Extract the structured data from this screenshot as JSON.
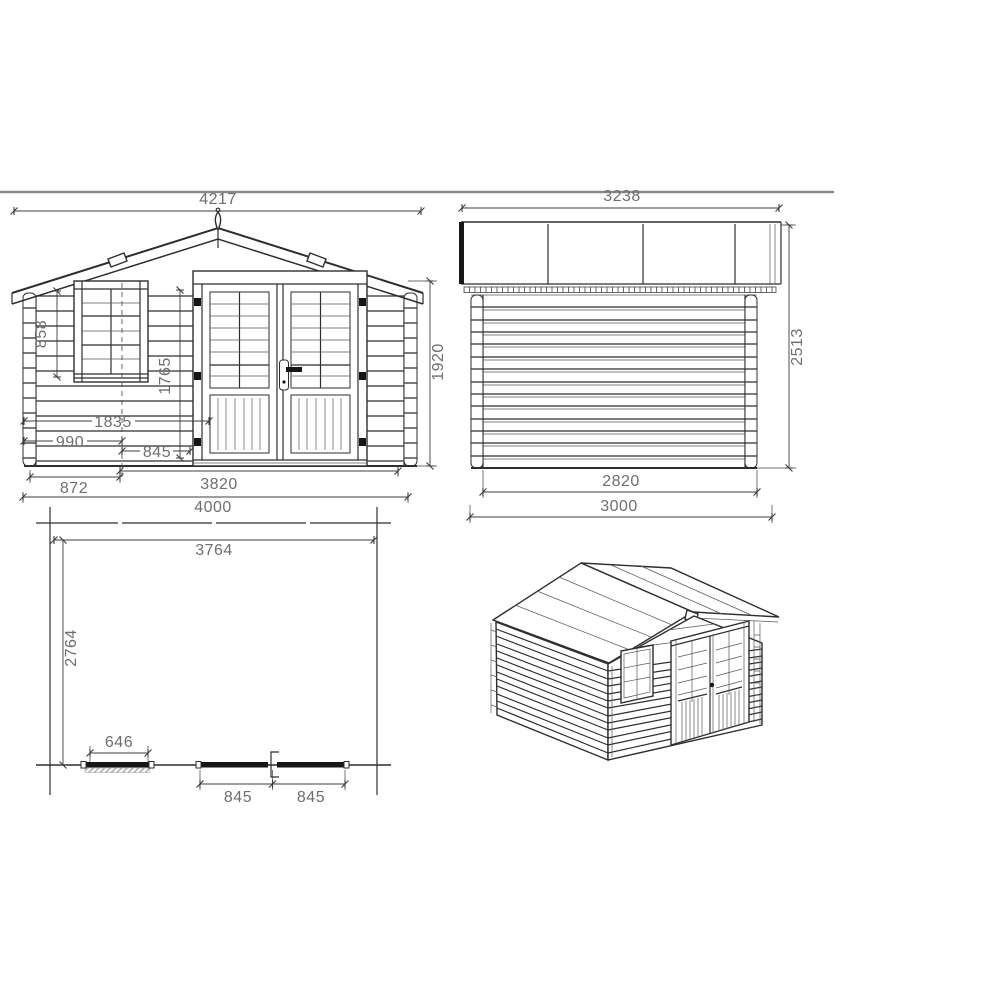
{
  "drawing": {
    "subject": "log-cabin-dimension-drawing",
    "views": {
      "front_elevation": {
        "dimensions": {
          "roof_width": "4217",
          "wall_height": "1920",
          "window_height": "858",
          "door_height": "1765",
          "left_to_door": "1835",
          "left_to_window_center": "990",
          "door_leaf": "845",
          "left_to_window": "872",
          "wall_width": "3820",
          "overall_width": "4000"
        }
      },
      "side_elevation": {
        "dimensions": {
          "roof_depth": "3238",
          "overall_height": "2513",
          "wall_depth": "2820",
          "overall_depth": "3000"
        }
      },
      "floor_plan": {
        "dimensions": {
          "interior_width": "3764",
          "interior_depth": "2764",
          "window_opening": "646",
          "door_leaf_left": "845",
          "door_leaf_right": "845"
        }
      }
    },
    "colors": {
      "line": "#2e2e2e",
      "dimension_text": "#6e6e6e",
      "divider": "#8a8a8a",
      "background": "#ffffff"
    }
  }
}
